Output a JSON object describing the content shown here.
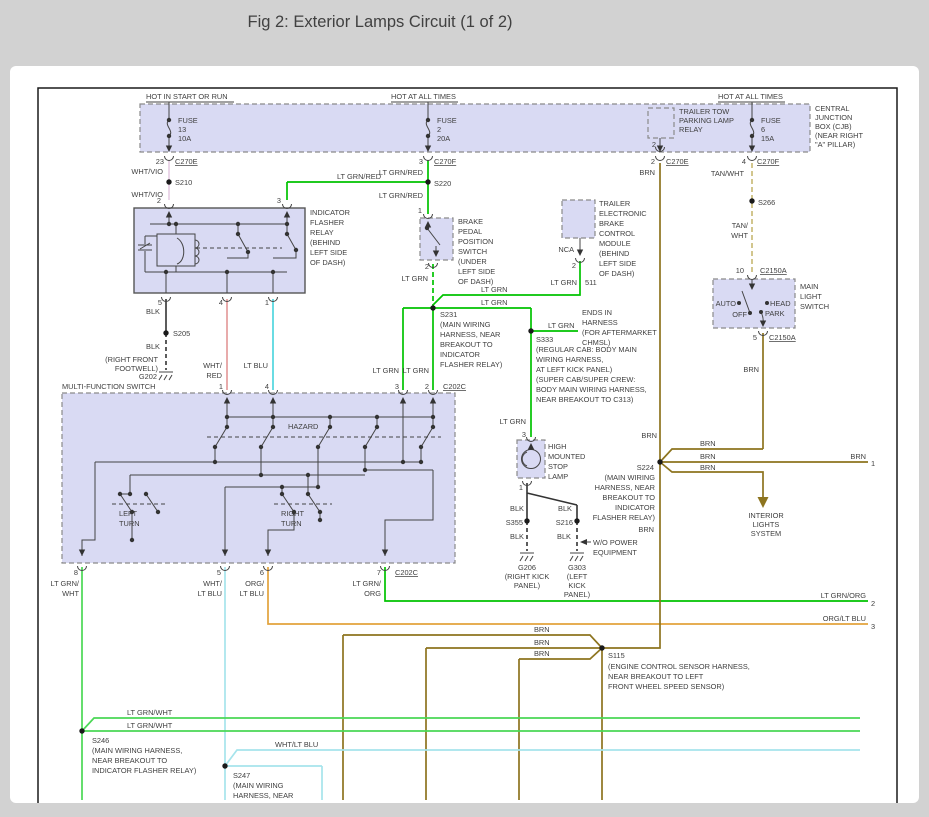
{
  "title": "Fig 2: Exterior Lamps Circuit (1 of 2)",
  "c": {
    "grn": "#00c300",
    "lgrn": "#4ad855",
    "cyan": "#4fd6de",
    "pcyan": "#a6e4ec",
    "org": "#e2a23c",
    "brn": "#8d741f",
    "tan": "#cbbd7a",
    "pink": "#e49c9c",
    "vio": "#e6cfe4",
    "blk": "#333333"
  },
  "t": {
    "hot1": "HOT IN START OR RUN",
    "hot2": "HOT AT ALL TIMES",
    "fuse": "FUSE",
    "f13": "13",
    "f13a": "10A",
    "f2": "2",
    "f2a": "20A",
    "f6": "6",
    "f6a": "15A",
    "cjb": [
      "CENTRAL",
      "JUNCTION",
      "BOX (CJB)",
      "(NEAR RIGHT",
      "\"A\" PILLAR)"
    ],
    "ttr": [
      "TRAILER TOW",
      "PARKING LAMP",
      "RELAY"
    ],
    "c270e": "C270E",
    "c270f": "C270F",
    "c202c": "C202C",
    "c2150a": "C2150A",
    "p23": "23",
    "p1": "1",
    "p2": "2",
    "p3": "3",
    "p4": "4",
    "p5": "5",
    "p6": "6",
    "p7": "7",
    "p8": "8",
    "p10": "10",
    "whtvio": "WHT/VIO",
    "ltgrnred": "LT GRN/RED",
    "brn": "BRN",
    "tanwht": "TAN/WHT",
    "tan_": "TAN/",
    "wht_": "WHT",
    "ltgrn": "LT GRN",
    "blk": "BLK",
    "ltblu": "LT BLU",
    "whtred_": "WHT/",
    "red_": "RED",
    "s205": "S205",
    "s210": "S210",
    "s216": "S216",
    "s220": "S220",
    "s224": "S224",
    "s231": "S231",
    "s246": "S246",
    "s247": "S247",
    "s266": "S266",
    "s333": "S333",
    "s355": "S355",
    "s115": "S115",
    "ifr": [
      "INDICATOR",
      "FLASHER",
      "RELAY",
      "(BEHIND",
      "LEFT SIDE",
      "OF DASH)"
    ],
    "bpp": [
      "BRAKE",
      "PEDAL",
      "POSITION",
      "SWITCH",
      "(UNDER",
      "LEFT SIDE",
      "OF DASH)"
    ],
    "tbc": [
      "TRAILER",
      "ELECTRONIC",
      "BRAKE",
      "CONTROL",
      "MODULE",
      "(BEHIND",
      "LEFT SIDE",
      "OF DASH)"
    ],
    "nca": "NCA",
    "c511": "511",
    "mwh": [
      "(MAIN WIRING",
      "HARNESS, NEAR",
      "BREAKOUT TO",
      "INDICATOR",
      "FLASHER RELAY)"
    ],
    "ends": [
      "ENDS IN",
      "HARNESS",
      "(FOR AFTERMARKET",
      "CHMSL)"
    ],
    "s333n": [
      "(REGULAR CAB: BODY MAIN",
      "WIRING HARNESS,",
      "AT LEFT KICK PANEL)",
      "(SUPER CAB/SUPER CREW:",
      "BODY MAIN WIRING HARNESS,",
      "NEAR BREAKOUT TO C313)"
    ],
    "g202": [
      "(RIGHT FRONT",
      "FOOTWELL)",
      "G202"
    ],
    "mls": [
      "MAIN",
      "LIGHT",
      "SWITCH"
    ],
    "auto": "AUTO",
    "off": "OFF",
    "head": "HEAD",
    "park": "PARK",
    "mfs": "MULTI-FUNCTION SWITCH",
    "hazard": "HAZARD",
    "left": "LEFT",
    "right": "RIGHT",
    "turn": "TURN",
    "lamp": [
      "HIGH",
      "MOUNTED",
      "STOP",
      "LAMP"
    ],
    "g206": [
      "G206",
      "(RIGHT KICK",
      "PANEL)"
    ],
    "g303": [
      "G303",
      "(LEFT",
      "KICK",
      "PANEL)"
    ],
    "wope": [
      "W/O POWER",
      "EQUIPMENT"
    ],
    "ils": [
      "INTERIOR",
      "LIGHTS",
      "SYSTEM"
    ],
    "s115n": [
      "(ENGINE CONTROL SENSOR HARNESS,",
      "NEAR BREAKOUT TO LEFT",
      "FRONT WHEEL SPEED SENSOR)"
    ],
    "ltgrnwht": "LT GRN/WHT",
    "whtltblu": "WHT/LT BLU",
    "ltgrnorg": "LT GRN/ORG",
    "orgltblu": "ORG/LT BLU",
    "lgw": [
      "LT GRN/",
      "WHT"
    ],
    "wlb": [
      "WHT/",
      "LT BLU"
    ],
    "olb": [
      "ORG/",
      "LT BLU"
    ],
    "lgo": [
      "LT GRN/",
      "ORG"
    ],
    "s246n": [
      "(MAIN WIRING HARNESS,",
      "NEAR BREAKOUT TO",
      "INDICATOR FLASHER RELAY)"
    ],
    "s247n": [
      "(MAIN WIRING",
      "HARNESS, NEAR"
    ],
    "e1": "1",
    "e2": "2",
    "e3": "3"
  }
}
